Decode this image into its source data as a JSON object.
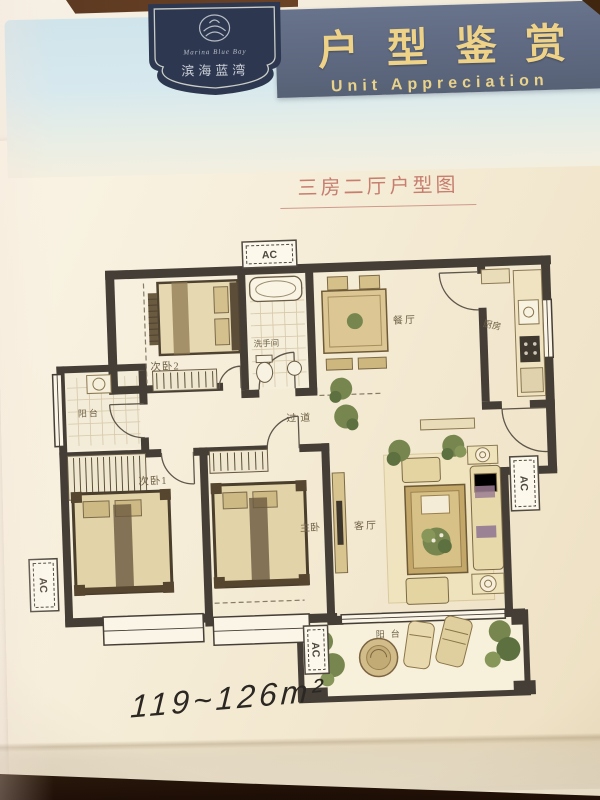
{
  "header": {
    "title_cn": "户型鉴赏",
    "title_en": "Unit Appreciation",
    "band_color": "#5f6a81",
    "text_color": "#eed287"
  },
  "logo": {
    "name_cn": "滨海蓝湾",
    "name_en": "Marina Blue Bay",
    "badge_color": "#2d3750"
  },
  "floorplan": {
    "title": "三房二厅户型图",
    "area_note": "119~126m²",
    "rooms": {
      "bedroom2": "次卧2",
      "bathroom": "洗手间",
      "dining": "餐厅",
      "kitchen": "厨房",
      "balcony_left": "阳台",
      "corridor": "过道",
      "bedroom1": "次卧1",
      "master": "主卧",
      "living": "客厅",
      "balcony_bottom": "阳台",
      "ac": "AC"
    },
    "colors": {
      "wall": "#443e36",
      "window": "#fbf5e7",
      "furniture": "#cdb88a",
      "furniture_dark": "#4e4231",
      "plant": "#77864e",
      "label": "#6f6248",
      "title": "#c67e6f",
      "handwriting": "#2b2723"
    }
  }
}
